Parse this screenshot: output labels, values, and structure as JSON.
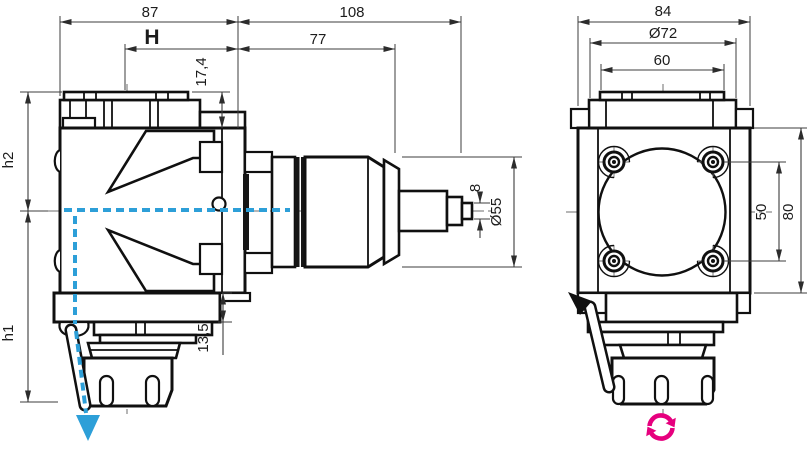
{
  "drawing": {
    "type": "technical-drawing",
    "subject": "right-angle driven tool holder, two orthographic views",
    "colors": {
      "line": "#101010",
      "dimension_line": "#3c3c3c",
      "coolant_blue": "#2d9fd8",
      "rotation_magenta": "#e6007e",
      "background": "#ffffff"
    },
    "icons": {
      "coolant_flow_arrow": "downward arrow on blue dashed coolant path",
      "tool_rotation_icon": "magenta circular double-arrow (spindle rotation)"
    },
    "views": {
      "side_view": {
        "dims": {
          "d87": "87",
          "d108": "108",
          "dH": "H",
          "d77": "77",
          "d17_4": "17,4",
          "h2": "h2",
          "h1": "h1",
          "d13_5": "13,5",
          "d8": "8",
          "d55": "Ø55"
        }
      },
      "front_view": {
        "dims": {
          "d84": "84",
          "d72": "Ø72",
          "d60": "60",
          "d50": "50",
          "d80": "80"
        }
      }
    }
  }
}
